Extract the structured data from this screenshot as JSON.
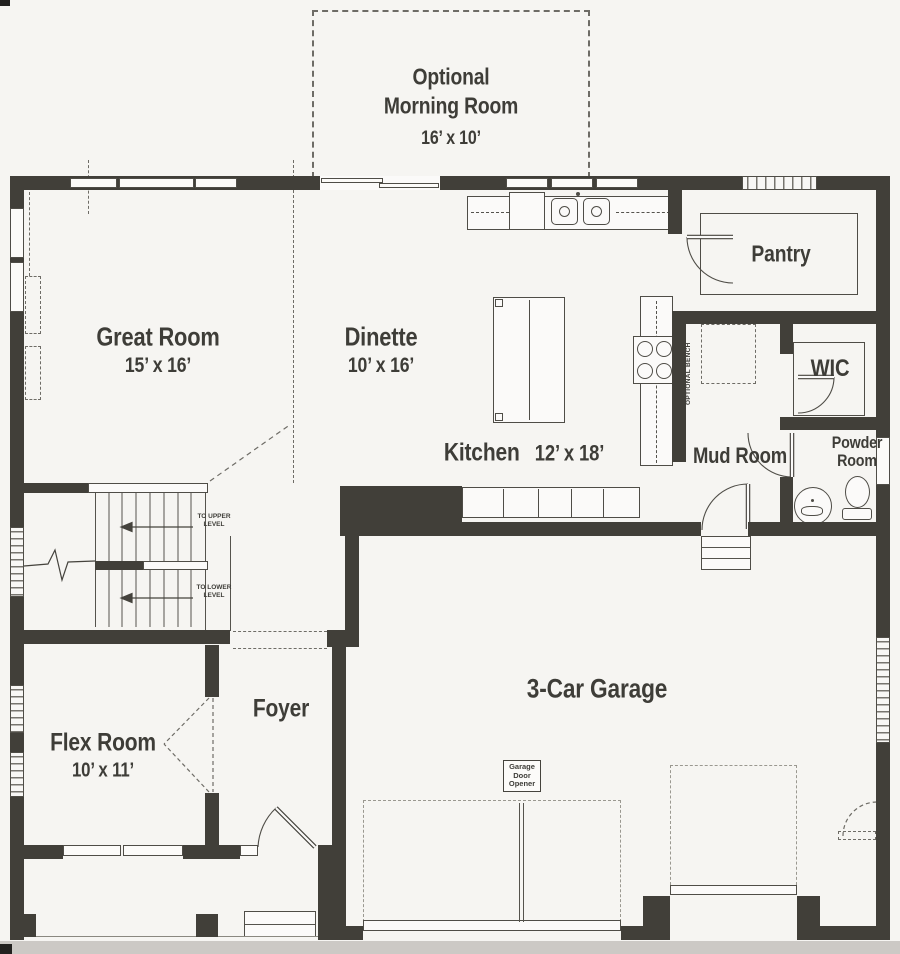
{
  "colors": {
    "wall": "#413f39",
    "paper": "#f6f5f2",
    "line": "#55534d",
    "dashed": "#6e6c66",
    "text": "#3e3d38"
  },
  "rooms": {
    "morning_room": {
      "line1": "Optional",
      "line2": "Morning Room",
      "dims": "16’ x 10’"
    },
    "great_room": {
      "name": "Great Room",
      "dims": "15’ x 16’"
    },
    "dinette": {
      "name": "Dinette",
      "dims": "10’ x 16’"
    },
    "kitchen": {
      "name": "Kitchen",
      "dims": "12’ x 18’"
    },
    "pantry": {
      "name": "Pantry"
    },
    "wic": {
      "name": "WIC"
    },
    "mud_room": {
      "name": "Mud Room"
    },
    "powder_room": {
      "line1": "Powder",
      "line2": "Room"
    },
    "foyer": {
      "name": "Foyer"
    },
    "flex_room": {
      "name": "Flex Room",
      "dims": "10’ x 11’"
    },
    "garage": {
      "name": "3-Car Garage"
    }
  },
  "annotations": {
    "to_upper_level": "TO UPPER LEVEL",
    "to_lower_level": "TO LOWER LEVEL",
    "optional_bench": "OPTIONAL BENCH",
    "garage_door_opener": "Garage Door Opener"
  }
}
